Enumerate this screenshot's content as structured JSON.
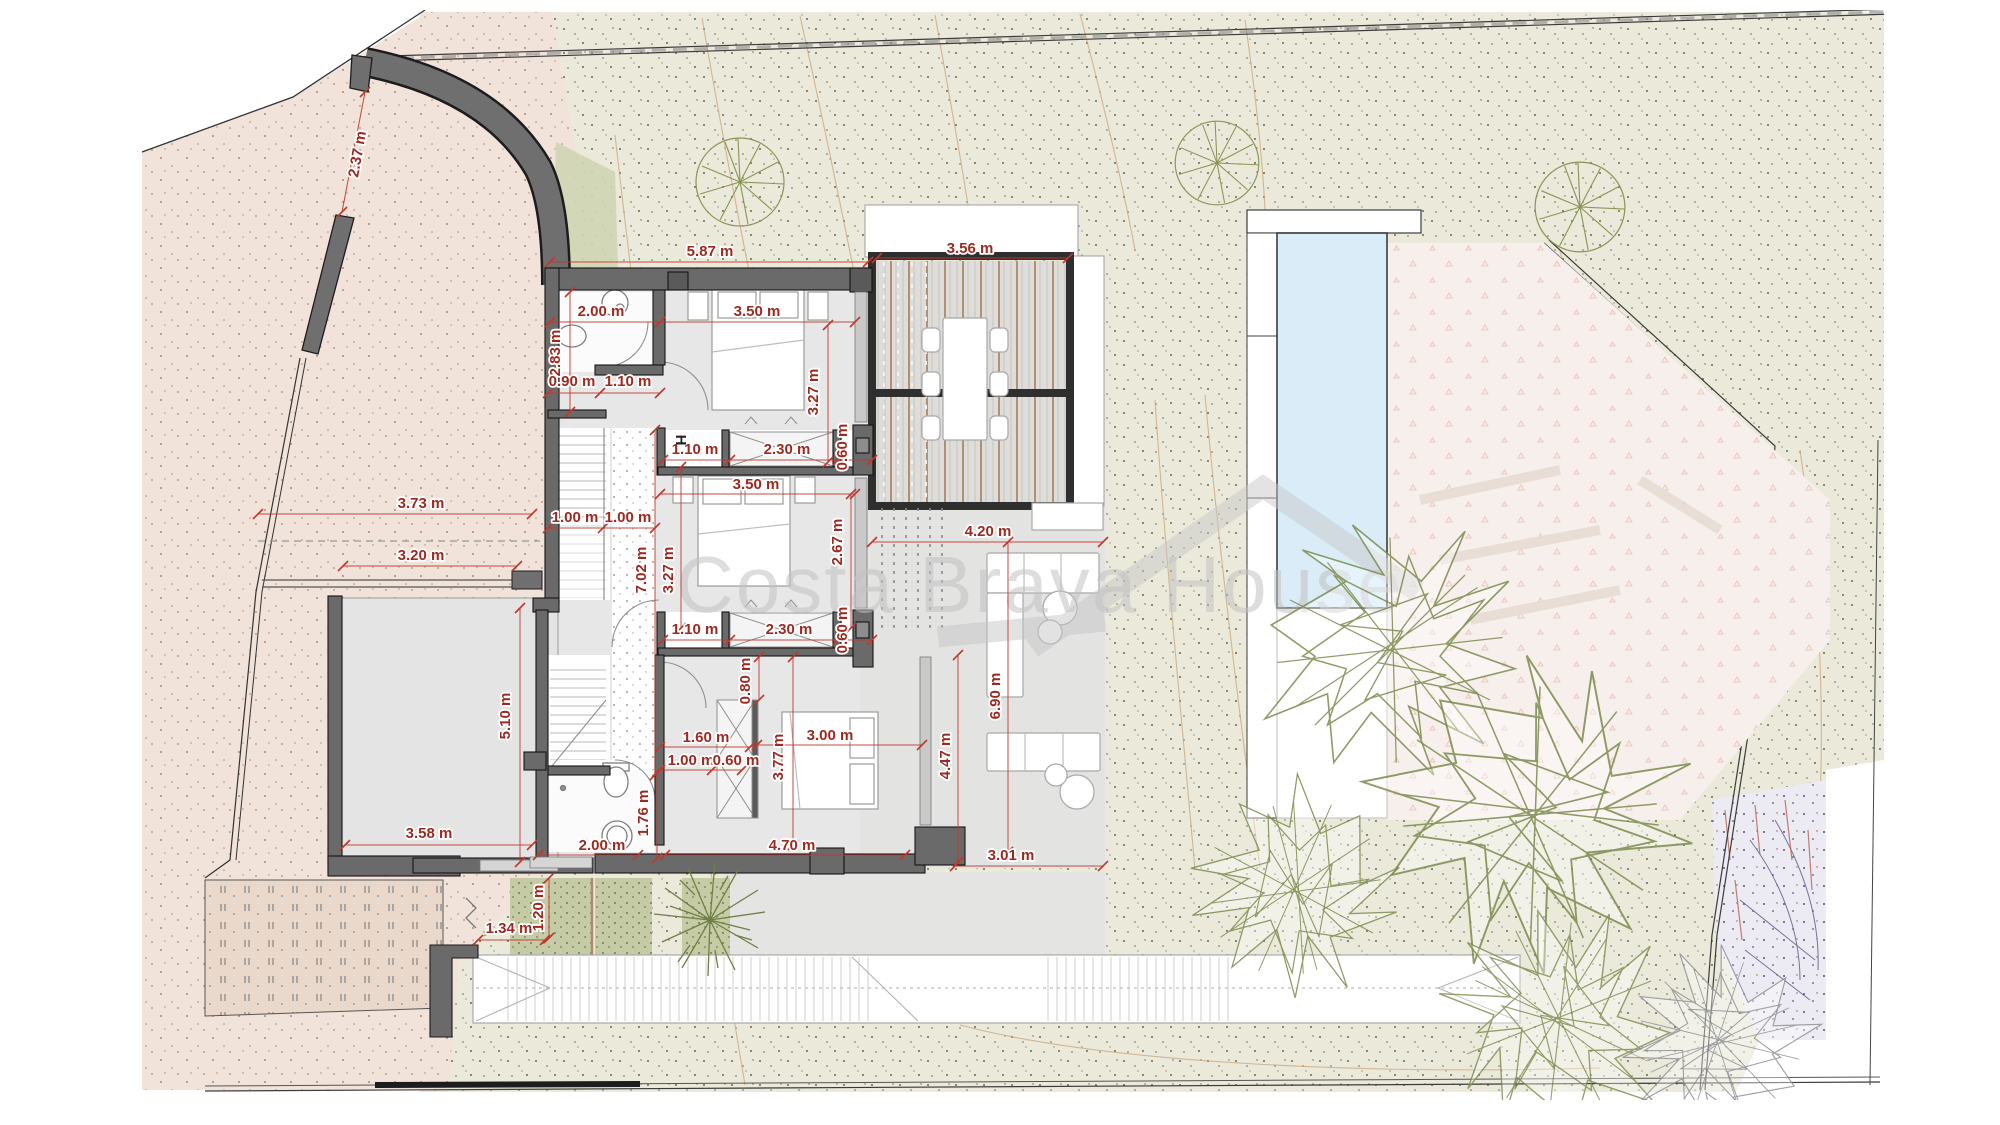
{
  "watermark": {
    "text": "Costa Brava House"
  },
  "plan": {
    "hall_marker": "H"
  },
  "dims": {
    "a1": "2.37 m",
    "a2": "5.87 m",
    "a3": "3.56 m",
    "a4": "2.00 m",
    "a5": "3.50 m",
    "a6": "2.83 m",
    "a7": "0.90 m",
    "a8": "1.10 m",
    "a9": "3.27 m",
    "a10": "1.10 m",
    "a11": "2.30 m",
    "a12": "0.60 m",
    "a13": "3.50 m",
    "a14": "3.73 m",
    "a15": "1.00 m",
    "a16": "1.00 m",
    "a17": "4.20 m",
    "a18": "3.20 m",
    "a19": "7.02 m",
    "a20": "3.27 m",
    "a21": "2.67 m",
    "a22": "1.10 m",
    "a23": "2.30 m",
    "a24": "0.60 m",
    "a25": "0.80 m",
    "a26": "5.10 m",
    "a27": "6.90 m",
    "a28": "1.60 m",
    "a29": "3.00 m",
    "a30": "1.00 m",
    "a31": "0.60 m",
    "a32": "3.77 m",
    "a33": "4.47 m",
    "a34": "1.76 m",
    "a35": "3.58 m",
    "a36": "2.00 m",
    "a37": "4.70 m",
    "a38": "3.01 m",
    "a39": "1.34 m",
    "a40": "1.20 m"
  }
}
